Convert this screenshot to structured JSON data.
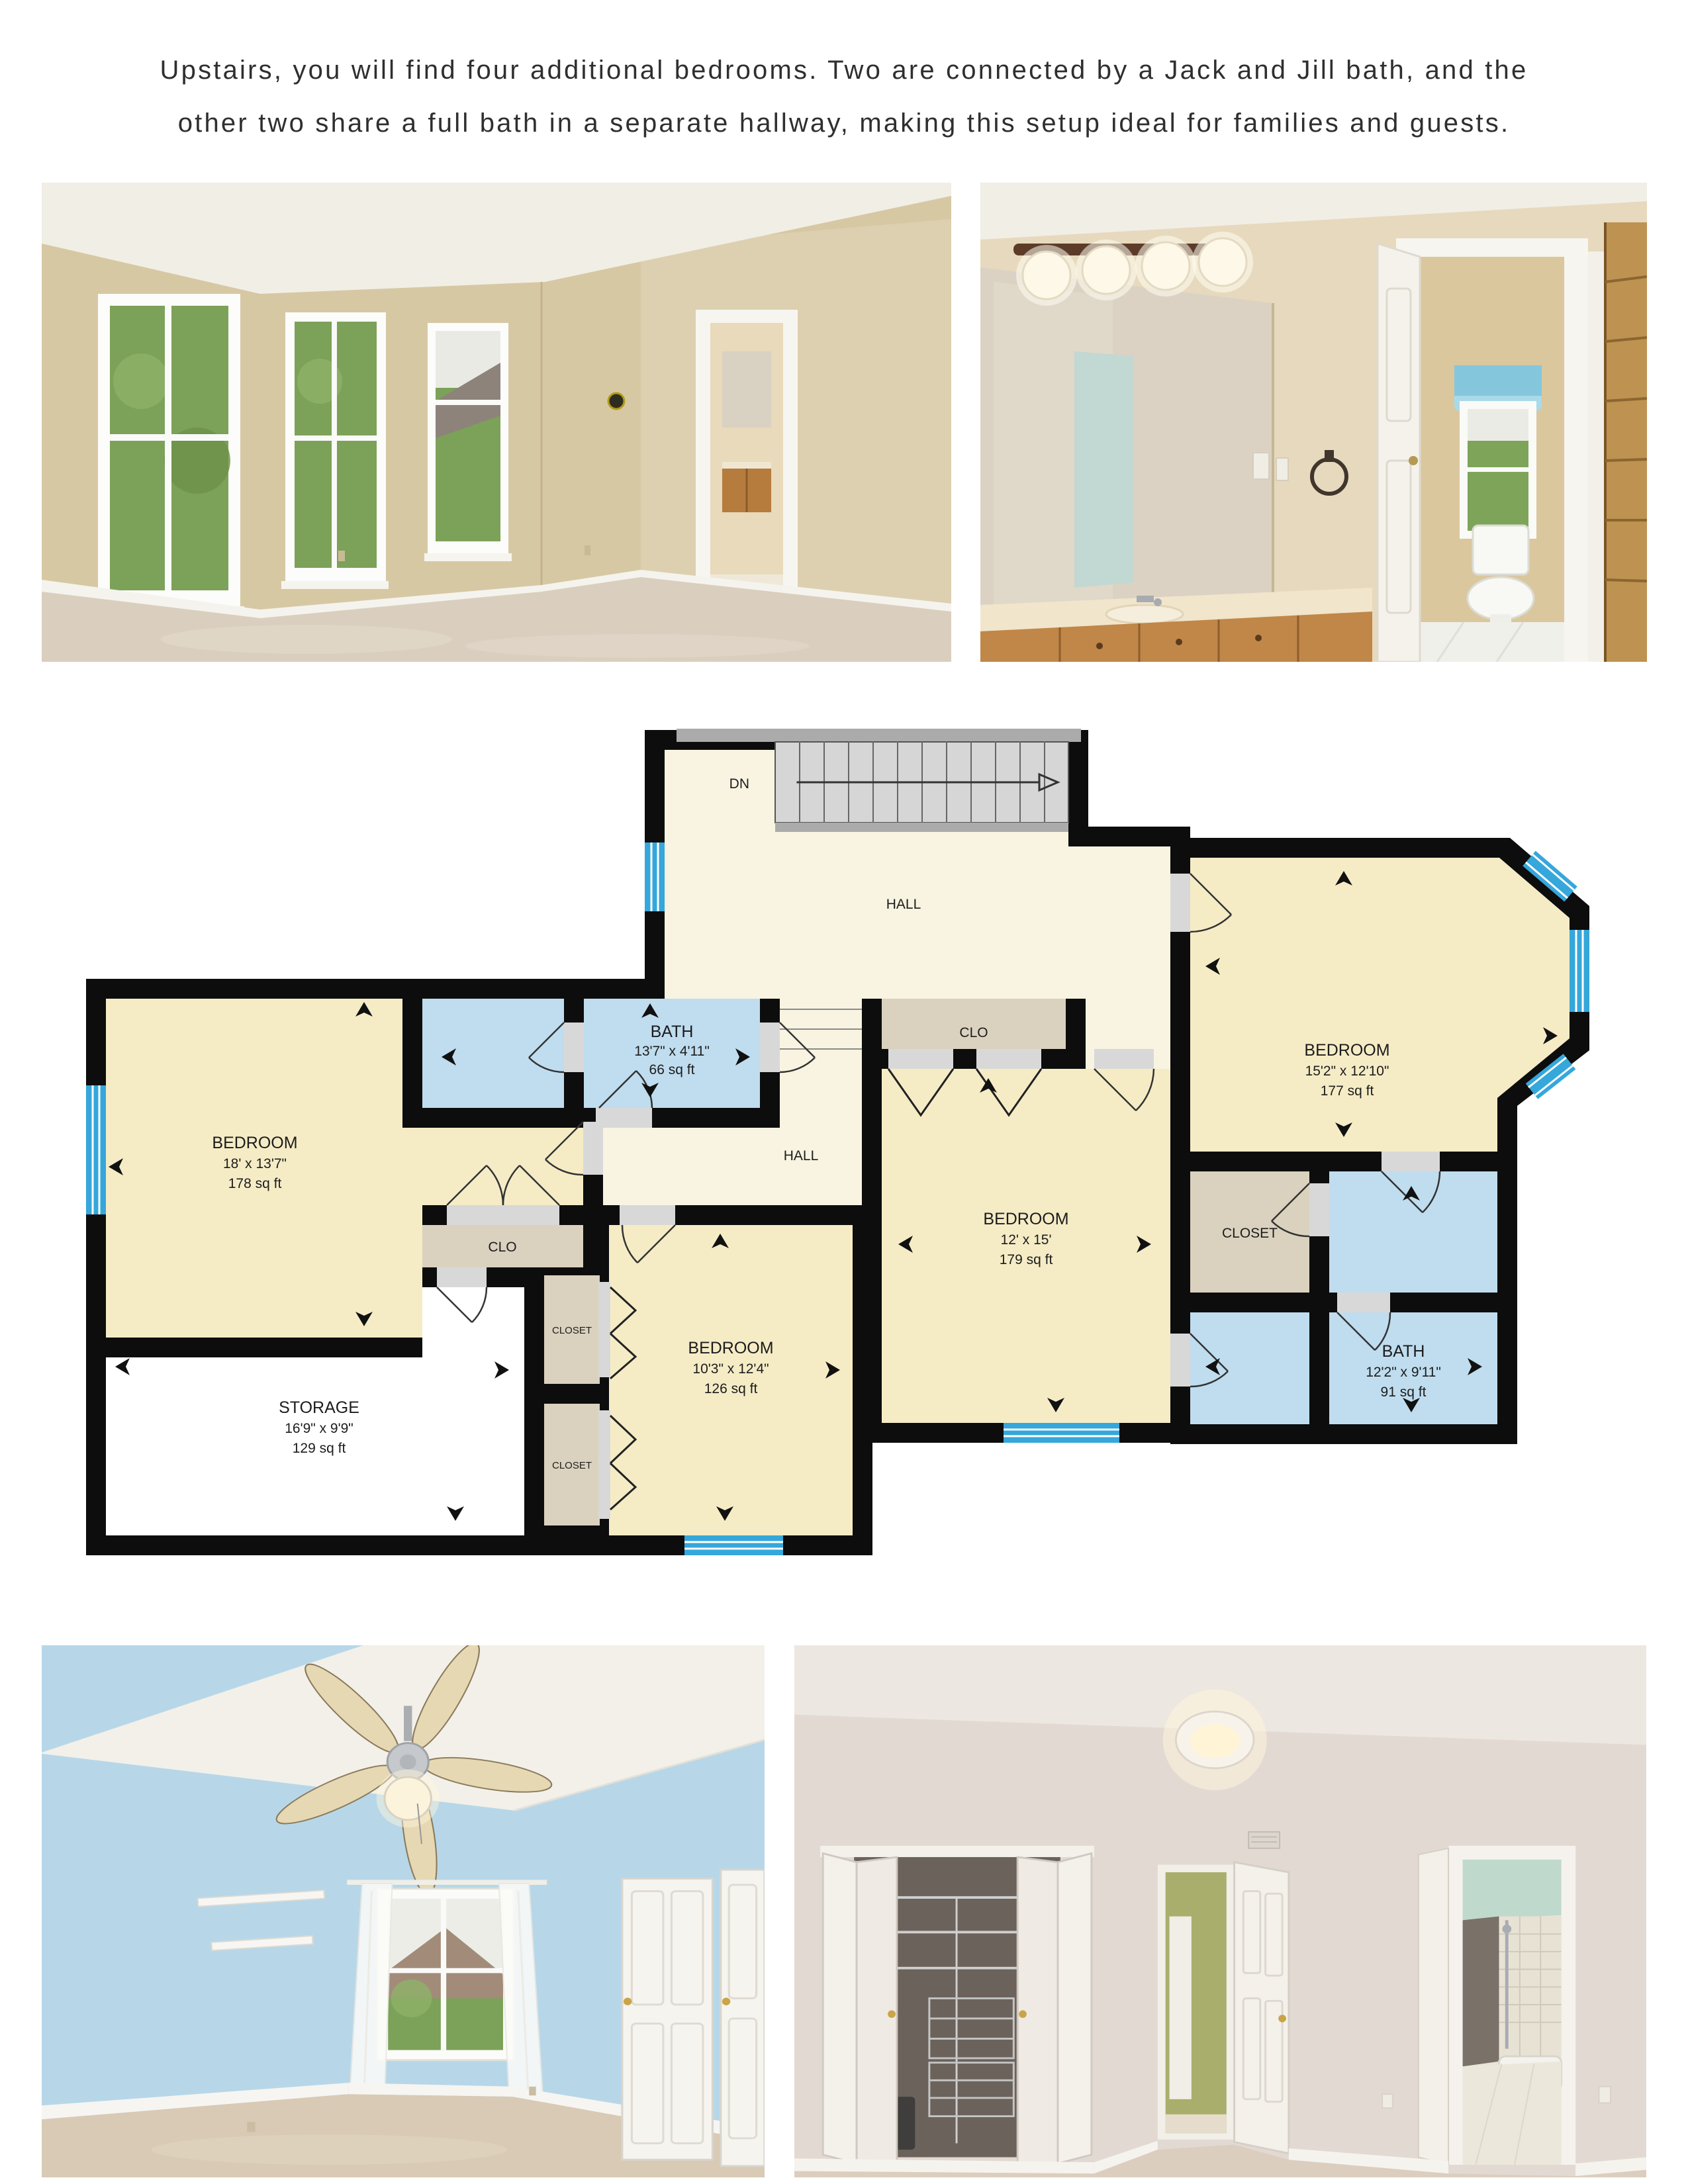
{
  "intro": {
    "line1": "Upstairs, you will find four additional bedrooms. Two are connected by a Jack and Jill bath, and the",
    "line2": "other two share a full bath in a separate hallway, making this setup ideal for families and guests."
  },
  "floorplan": {
    "labels": {
      "down": "DN",
      "hall_upper": "HALL",
      "hall_lower": "HALL",
      "clo_right": "CLO",
      "clo_left": "CLO",
      "closet_right": "CLOSET",
      "closet_small_upper": "CLOSET",
      "closet_small_lower": "CLOSET"
    },
    "rooms": {
      "bedroom_left": {
        "name": "BEDROOM",
        "dims": "18' x 13'7\"",
        "area": "178 sq ft"
      },
      "bath_jackjill": {
        "name": "BATH",
        "dims": "13'7\" x 4'11\"",
        "area": "66 sq ft"
      },
      "bedroom_top_right": {
        "name": "BEDROOM",
        "dims": "15'2\" x 12'10\"",
        "area": "177 sq ft"
      },
      "bedroom_center": {
        "name": "BEDROOM",
        "dims": "12' x 15'",
        "area": "179 sq ft"
      },
      "bedroom_small": {
        "name": "BEDROOM",
        "dims": "10'3\" x 12'4\"",
        "area": "126 sq ft"
      },
      "bath_right": {
        "name": "BATH",
        "dims": "12'2\" x 9'11\"",
        "area": "91 sq ft"
      },
      "storage": {
        "name": "STORAGE",
        "dims": "16'9\" x 9'9\"",
        "area": "129 sq ft"
      }
    },
    "colors": {
      "wall": "#0d0d0d",
      "bedroom": "#f5ecc6",
      "hall": "#f8f4e1",
      "bath": "#bfddef",
      "closet": "#dad2be",
      "storage": "#ffffff",
      "window": "#35a7db",
      "opening": "#d8d8d8",
      "stair": "#d6d6d6"
    }
  }
}
